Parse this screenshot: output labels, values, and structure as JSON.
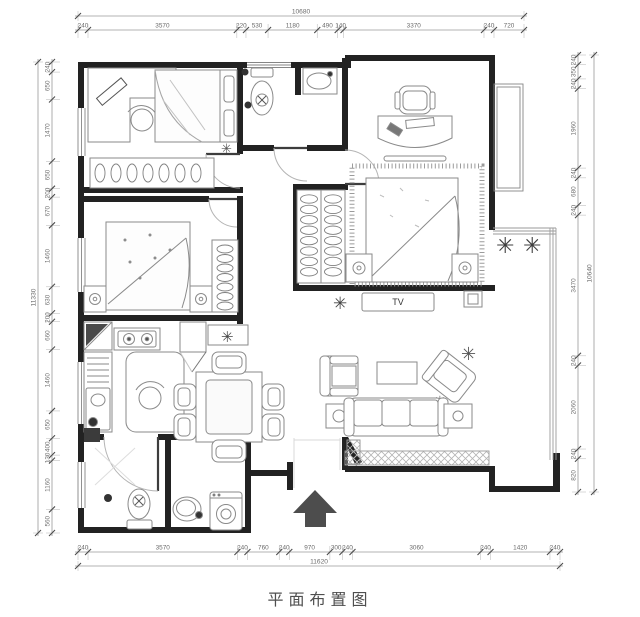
{
  "title": "平面布置图",
  "labels": {
    "tv": "TV"
  },
  "icons": {
    "plant": "✳"
  },
  "dimensions": {
    "top": {
      "total": "10680",
      "segments": [
        "240",
        "3570",
        "220",
        "530",
        "1180",
        "490",
        "140",
        "3370",
        "240",
        "720"
      ]
    },
    "bottom": {
      "total": "11620",
      "segments": [
        "240",
        "3570",
        "240",
        "760",
        "240",
        "970",
        "300",
        "240",
        "3060",
        "240",
        "1420",
        "240"
      ]
    },
    "left": {
      "total": "11330",
      "segments": [
        "240",
        "650",
        "1470",
        "650",
        "200",
        "670",
        "1460",
        "630",
        "200",
        "660",
        "1460",
        "650",
        "400",
        "130",
        "1160",
        "560"
      ]
    },
    "right": {
      "total": "10640",
      "segments": [
        "240",
        "350",
        "240",
        "1960",
        "240",
        "680",
        "240",
        "3470",
        "240",
        "2060",
        "240",
        "820"
      ]
    }
  },
  "colors": {
    "wall": "#222222",
    "furniture_line": "#8a8a8a",
    "dimension_line": "#9a9a9a",
    "dimension_text": "#6b6b6b",
    "arrow": "#4d4d4d",
    "title_text": "#4f4f4f"
  }
}
